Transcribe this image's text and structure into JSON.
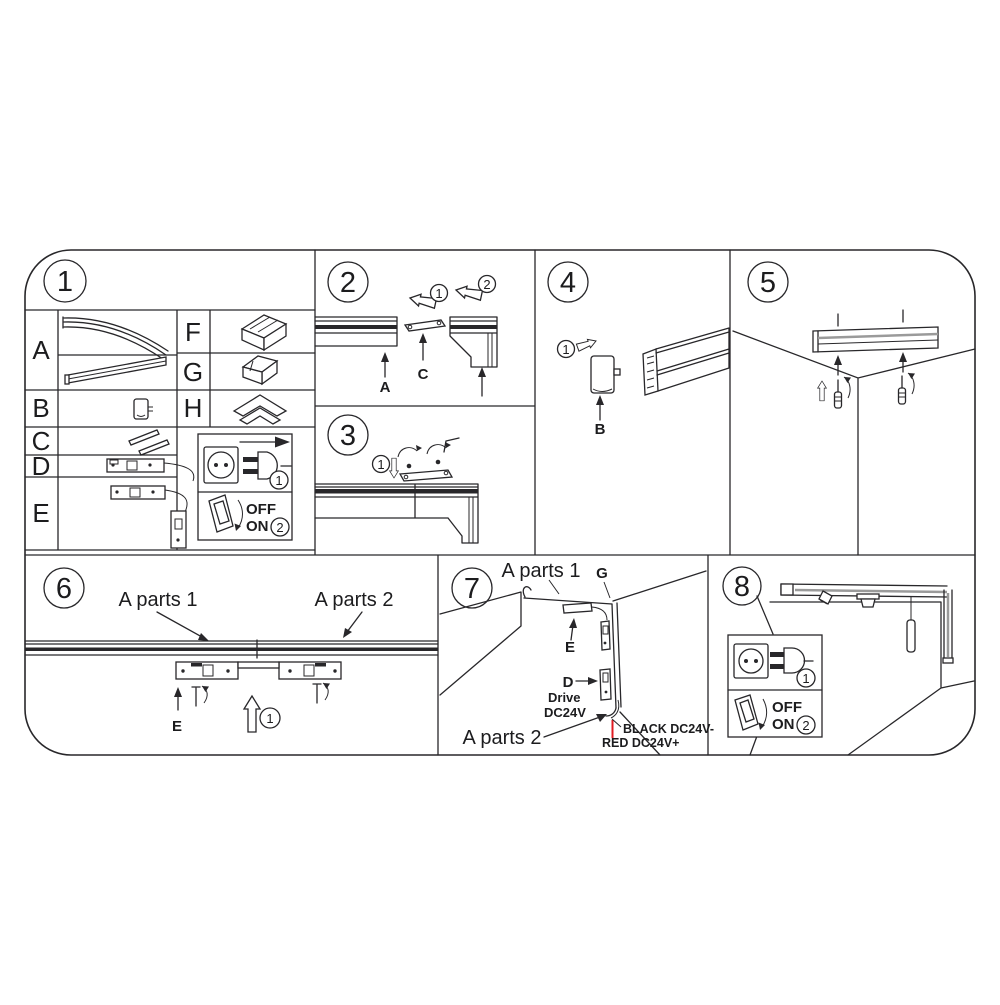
{
  "colors": {
    "line": "#28272a",
    "red": "#e11b22",
    "gray": "#9a9a9a"
  },
  "p1": {
    "num": "1",
    "letters": [
      "A",
      "B",
      "C",
      "D",
      "E",
      "F",
      "G",
      "H"
    ],
    "power": {
      "step1": "1",
      "step2": "2",
      "off": "OFF",
      "on": "ON"
    }
  },
  "p2": {
    "num": "2",
    "step1": "1",
    "step2": "2",
    "label_a": "A",
    "label_c": "C"
  },
  "p3": {
    "num": "3",
    "step1": "1"
  },
  "p4": {
    "num": "4",
    "step1": "1",
    "label_b": "B"
  },
  "p5": {
    "num": "5"
  },
  "p6": {
    "num": "6",
    "a_parts_1": "A parts 1",
    "a_parts_2": "A parts 2",
    "label_e": "E",
    "step1": "1"
  },
  "p7": {
    "num": "7",
    "a_parts_1": "A parts 1",
    "a_parts_2": "A parts 2",
    "label_g": "G",
    "label_e": "E",
    "label_d": "D",
    "drive_1": "Drive",
    "drive_2": "DC24V",
    "wire_black": "BLACK DC24V-",
    "wire_red": "RED DC24V+"
  },
  "p8": {
    "num": "8",
    "power": {
      "step1": "1",
      "step2": "2",
      "off": "OFF",
      "on": "ON"
    }
  }
}
